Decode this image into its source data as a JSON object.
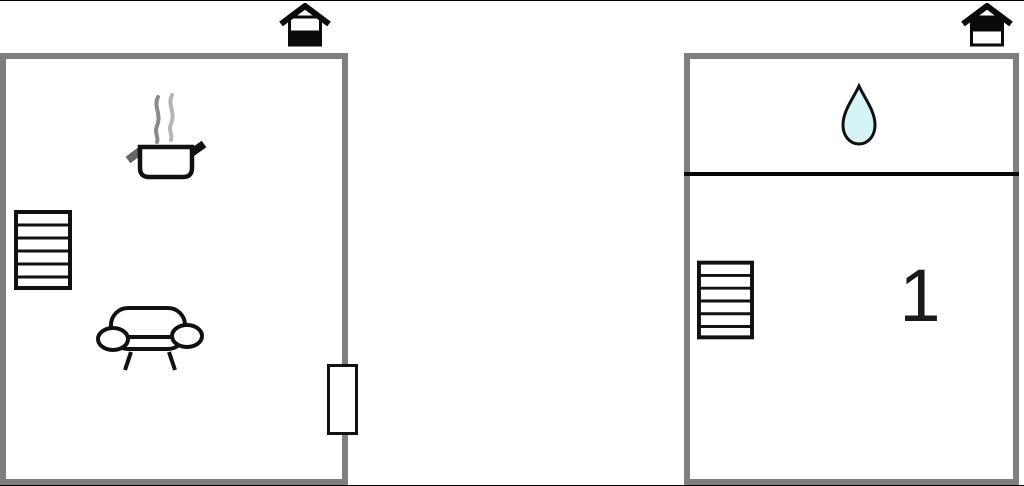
{
  "page": {
    "type": "floor-plan",
    "background": "#ffffff"
  },
  "colors": {
    "wall_gray": "#7f7f7f",
    "icon_stroke": "#111111",
    "water_drop_fill": "#d6f4f6",
    "steam_gray_dark": "#8a8a8a",
    "steam_gray_light": "#b5b5b5",
    "fill_black": "#0a0a0a"
  },
  "units": [
    {
      "name": "ground-floor-unit",
      "floor_indicator": "house-ground-floor-icon",
      "icons": [
        "cooking-pot-icon",
        "stairs-icon",
        "sofa-icon",
        "door-icon"
      ],
      "room_number": ""
    },
    {
      "name": "upper-floor-unit",
      "floor_indicator": "house-upper-floor-icon",
      "icons": [
        "water-drop-icon",
        "stairs-icon"
      ],
      "room_number": "1"
    }
  ]
}
